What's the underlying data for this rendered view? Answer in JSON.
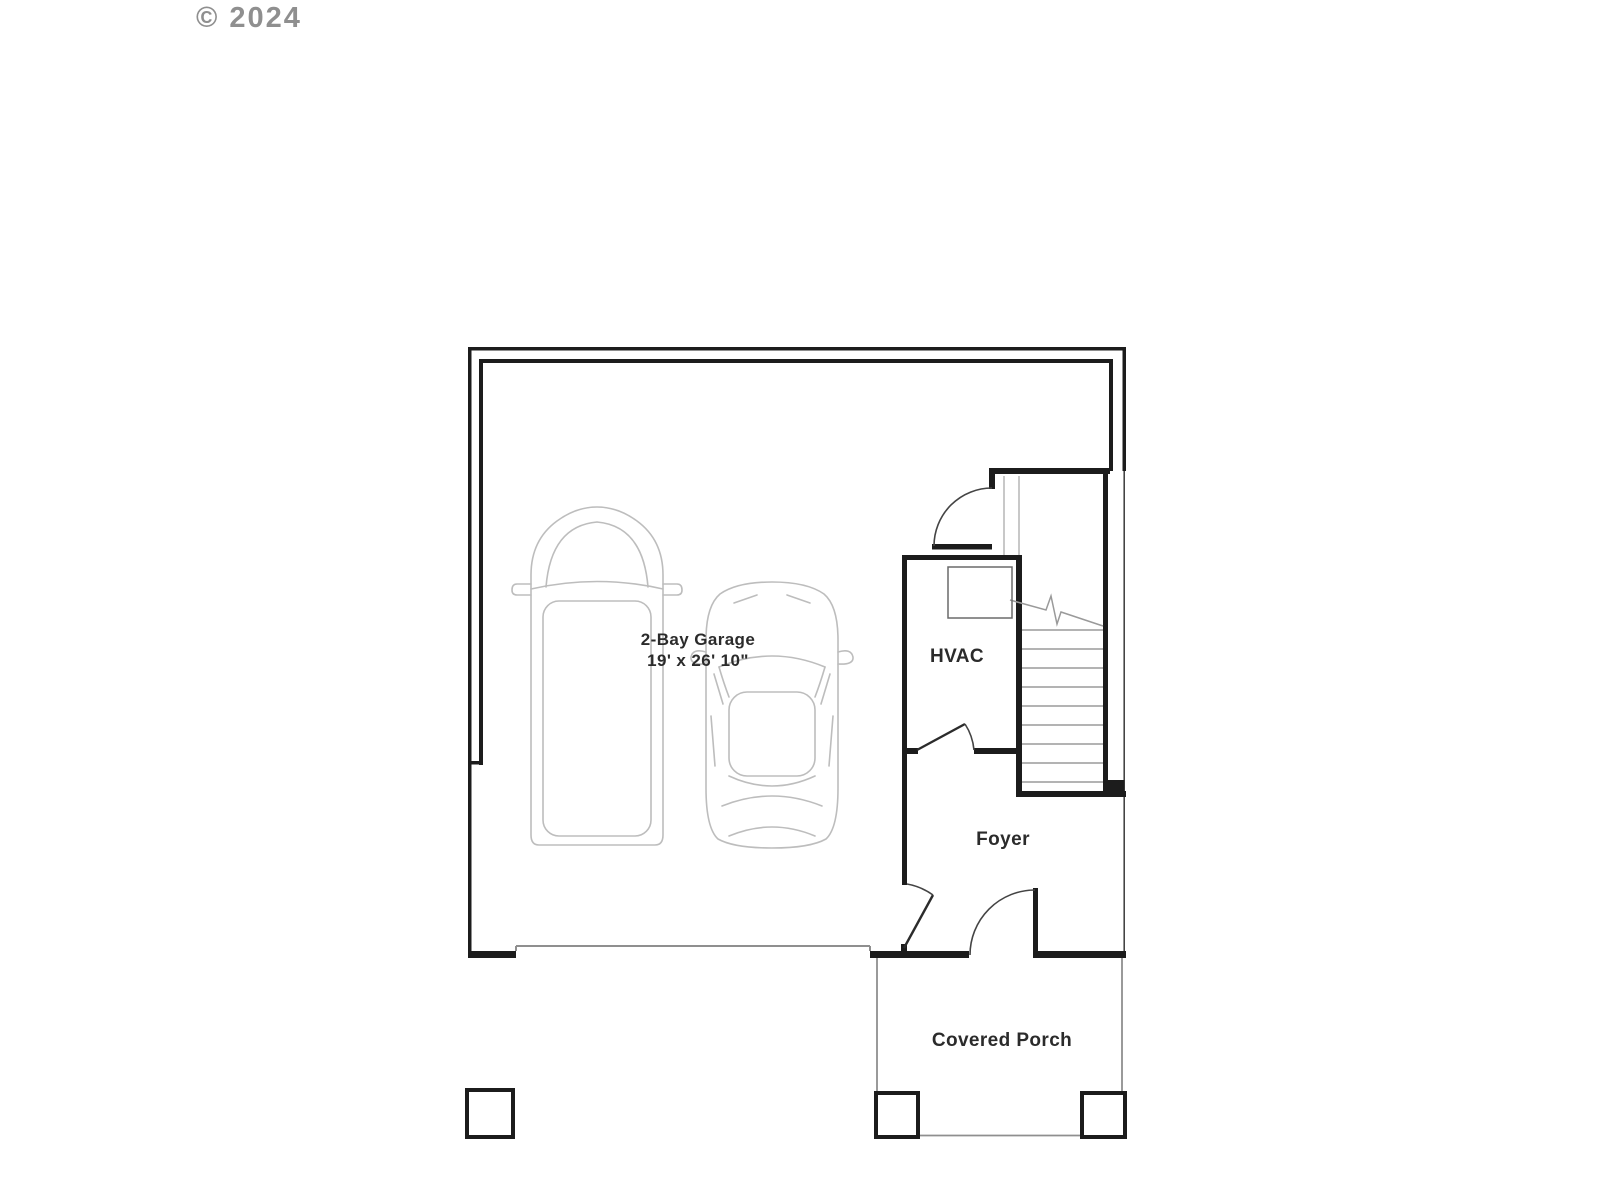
{
  "copyright": "© 2024",
  "plan": {
    "rooms": [
      {
        "id": "garage",
        "label": "2-Bay Garage",
        "dimensions": "19' x 26' 10\""
      },
      {
        "id": "hvac",
        "label": "HVAC"
      },
      {
        "id": "foyer",
        "label": "Foyer"
      },
      {
        "id": "porch",
        "label": "Covered Porch"
      }
    ],
    "colors": {
      "wall": "#1c1c1c",
      "thin_line": "#8f8f8f",
      "stair_line": "#9a9a9a",
      "vehicle_line": "#bdbdbd",
      "label_text": "#2b2b2b",
      "copyright_text": "#8f8f8f",
      "background": "#ffffff"
    }
  }
}
